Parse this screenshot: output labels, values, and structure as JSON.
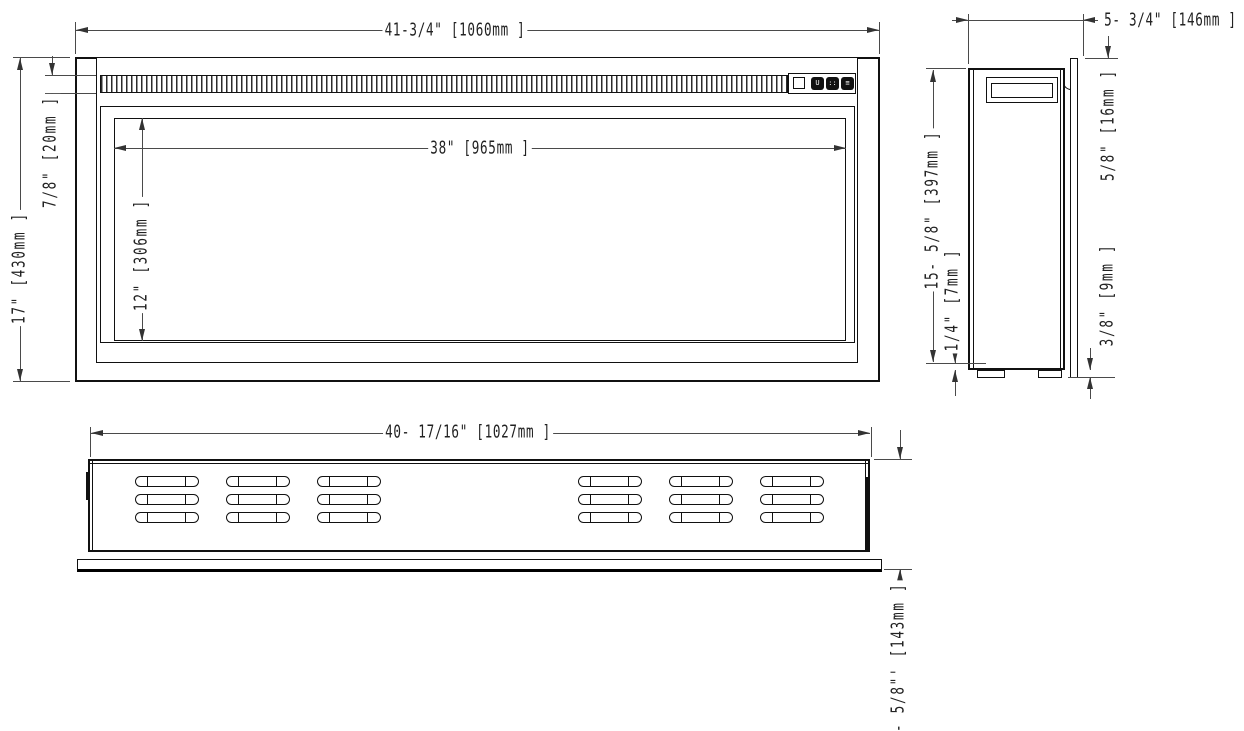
{
  "drawing": {
    "dimensions": {
      "front_width": "41-3/4\" [1060mm ]",
      "front_height": "17\" [430mm ]",
      "grille_height": "7/8\" [20mm ]",
      "glass_width": "38\" [965mm ]",
      "glass_height": "12\" [306mm ]",
      "side_depth": "5- 3/4\" [146mm ]",
      "flange_reveal": "5/8\" [16mm ]",
      "side_body_height": "15- 5/8\" [397mm ]",
      "foot_gap": "1/4\" [7mm ]",
      "flange_offset": "3/8\" [9mm ]",
      "cutout_width": "40- 17/16\" [1027mm ]",
      "cutout_depth": "5- 5/8\"' [143mm ]"
    },
    "control_panel": {
      "buttons": [
        {
          "icon": "power-icon",
          "glyph": "U"
        },
        {
          "icon": "dots-icon",
          "glyph": "::"
        },
        {
          "icon": "menu-icon",
          "glyph": "≡"
        }
      ]
    },
    "bottom_view": {
      "louver_groups": 2,
      "louver_columns": 3,
      "louver_rows": 3
    }
  }
}
